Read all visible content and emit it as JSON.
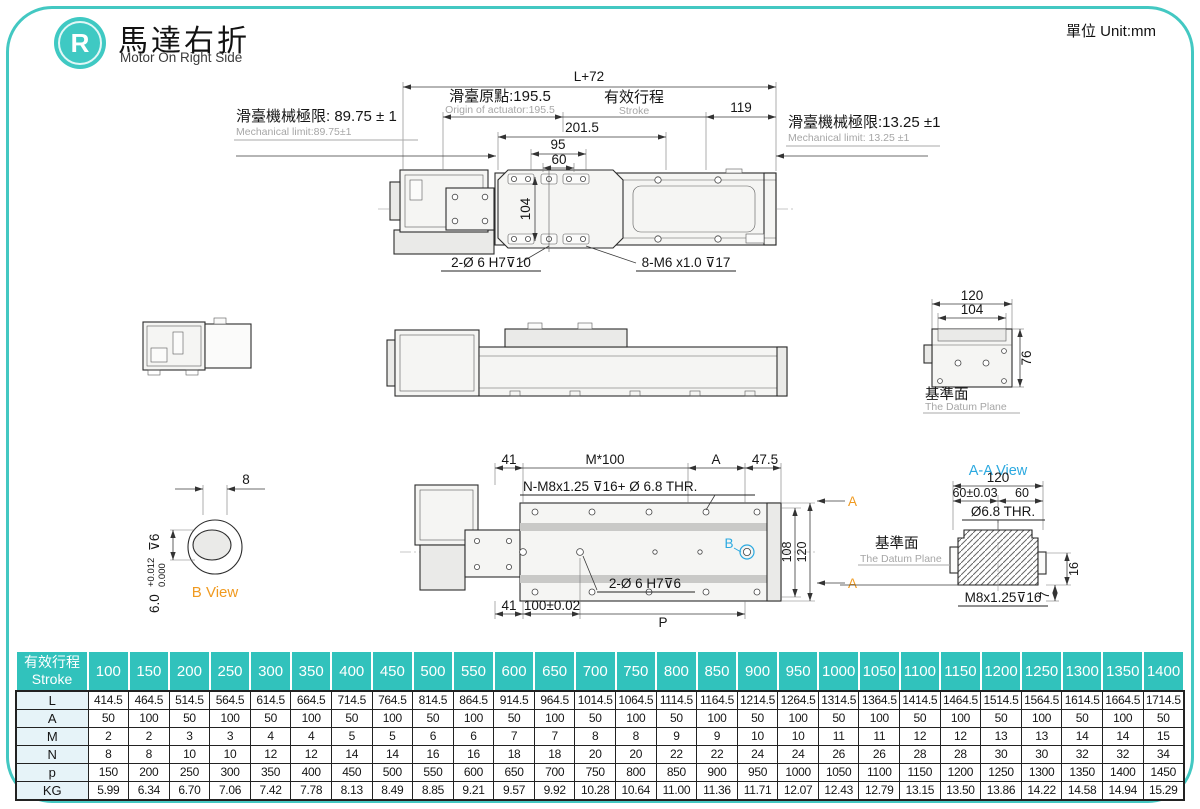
{
  "page": {
    "unit": "單位 Unit:mm",
    "logo": "R",
    "title_zh": "馬達右折",
    "title_en": "Motor On Right Side"
  },
  "top_view": {
    "dim_total": "L+72",
    "origin_zh": "滑臺原點:195.5",
    "origin_en": "Origin of actuator:195.5",
    "stroke_zh": "有效行程",
    "stroke_en": "Stroke",
    "dim_right_end": "119",
    "limit_left_zh": "滑臺機械極限: 89.75 ± 1",
    "limit_left_en": "Mechanical limit:89.75±1",
    "limit_right_zh": "滑臺機械極限:13.25 ±1",
    "limit_right_en": "Mechanical limit: 13.25 ±1",
    "dim_carriage": "201.5",
    "dim_95": "95",
    "dim_60": "60",
    "dim_104": "104",
    "callout_dowel": "2-Ø 6  H7⊽10",
    "callout_screw": "8-M6 x1.0 ⊽17"
  },
  "end_view": {
    "dim_120": "120",
    "dim_104": "104",
    "dim_76": "76",
    "datum_zh": "基準面",
    "datum_en": "The Datum Plane"
  },
  "b_view": {
    "dim_8": "8",
    "label": "B View",
    "bore": "6.0",
    "tol_up": "+0.012",
    "tol_dn": "0.000",
    "depth": "⊽6"
  },
  "bottom_view": {
    "dim_41_top": "41",
    "dim_pitch": "M*100",
    "dim_a": "A",
    "dim_47_5": "47.5",
    "callout_thread": "N-M8x1.25 ⊽16+ Ø 6.8 THR.",
    "dim_108": "108",
    "dim_120": "120",
    "label_b": "B",
    "label_a": "A",
    "dim_41_bot": "41",
    "dim_100": "100±0.02",
    "callout_dowel": "2-Ø 6  H7⊽6",
    "dim_p": "P"
  },
  "aa_view": {
    "title": "A-A View",
    "dim_120": "120",
    "dim_60_tol": "60±0.03",
    "dim_60": "60",
    "callout_hole": "Ø6.8  THR.",
    "datum_zh": "基準面",
    "datum_en": "The Datum Plane",
    "callout_thread": "M8x1.25⊽16",
    "dim_16": "16",
    "dim_7": "7"
  },
  "table": {
    "header_zh": "有效行程",
    "header_en": "Stroke",
    "strokes": [
      "100",
      "150",
      "200",
      "250",
      "300",
      "350",
      "400",
      "450",
      "500",
      "550",
      "600",
      "650",
      "700",
      "750",
      "800",
      "850",
      "900",
      "950",
      "1000",
      "1050",
      "1100",
      "1150",
      "1200",
      "1250",
      "1300",
      "1350",
      "1400"
    ],
    "rows": [
      {
        "label": "L",
        "values": [
          "414.5",
          "464.5",
          "514.5",
          "564.5",
          "614.5",
          "664.5",
          "714.5",
          "764.5",
          "814.5",
          "864.5",
          "914.5",
          "964.5",
          "1014.5",
          "1064.5",
          "1114.5",
          "1164.5",
          "1214.5",
          "1264.5",
          "1314.5",
          "1364.5",
          "1414.5",
          "1464.5",
          "1514.5",
          "1564.5",
          "1614.5",
          "1664.5",
          "1714.5"
        ]
      },
      {
        "label": "A",
        "values": [
          "50",
          "100",
          "50",
          "100",
          "50",
          "100",
          "50",
          "100",
          "50",
          "100",
          "50",
          "100",
          "50",
          "100",
          "50",
          "100",
          "50",
          "100",
          "50",
          "100",
          "50",
          "100",
          "50",
          "100",
          "50",
          "100",
          "50"
        ]
      },
      {
        "label": "M",
        "values": [
          "2",
          "2",
          "3",
          "3",
          "4",
          "4",
          "5",
          "5",
          "6",
          "6",
          "7",
          "7",
          "8",
          "8",
          "9",
          "9",
          "10",
          "10",
          "11",
          "11",
          "12",
          "12",
          "13",
          "13",
          "14",
          "14",
          "15"
        ]
      },
      {
        "label": "N",
        "values": [
          "8",
          "8",
          "10",
          "10",
          "12",
          "12",
          "14",
          "14",
          "16",
          "16",
          "18",
          "18",
          "20",
          "20",
          "22",
          "22",
          "24",
          "24",
          "26",
          "26",
          "28",
          "28",
          "30",
          "30",
          "32",
          "32",
          "34"
        ]
      },
      {
        "label": "p",
        "values": [
          "150",
          "200",
          "250",
          "300",
          "350",
          "400",
          "450",
          "500",
          "550",
          "600",
          "650",
          "700",
          "750",
          "800",
          "850",
          "900",
          "950",
          "1000",
          "1050",
          "1100",
          "1150",
          "1200",
          "1250",
          "1300",
          "1350",
          "1400",
          "1450"
        ]
      },
      {
        "label": "KG",
        "values": [
          "5.99",
          "6.34",
          "6.70",
          "7.06",
          "7.42",
          "7.78",
          "8.13",
          "8.49",
          "8.85",
          "9.21",
          "9.57",
          "9.92",
          "10.28",
          "10.64",
          "11.00",
          "11.36",
          "11.71",
          "12.07",
          "12.43",
          "12.79",
          "13.15",
          "13.50",
          "13.86",
          "14.22",
          "14.58",
          "14.94",
          "15.29"
        ]
      }
    ]
  }
}
